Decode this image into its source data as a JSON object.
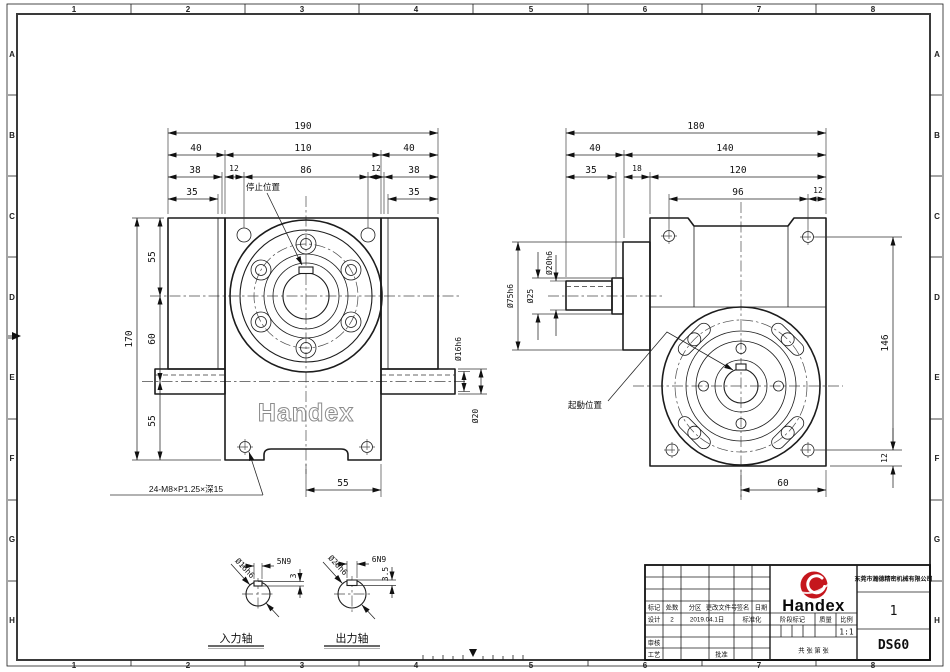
{
  "grid": {
    "cols": [
      "1",
      "2",
      "3",
      "4",
      "5",
      "6",
      "7",
      "8"
    ],
    "rows": [
      "A",
      "B",
      "C",
      "D",
      "E",
      "F",
      "G",
      "H"
    ]
  },
  "front_view": {
    "w190": "190",
    "w40l": "40",
    "w110": "110",
    "w40r": "40",
    "w38l": "38",
    "w12l": "12",
    "w86": "86",
    "w12r": "12",
    "w38r": "38",
    "w35l": "35",
    "w35r": "35",
    "stop_label": "停止位置",
    "h170": "170",
    "h55t": "55",
    "h60": "60",
    "h55b": "55",
    "d16": "Ø16h6",
    "d20": "Ø20",
    "b55": "55",
    "tap_note": "24-M8×P1.25×深15",
    "emboss": "Handex"
  },
  "side_view": {
    "w180": "180",
    "w40": "40",
    "w140": "140",
    "w35": "35",
    "w18": "18",
    "w120": "120",
    "w96": "96",
    "w12": "12",
    "d75": "Ø75h6",
    "d25": "Ø25",
    "d20": "Ø20h6",
    "h146": "146",
    "h12": "12",
    "b60": "60",
    "start_label": "起動位置"
  },
  "input_detail": {
    "dia": "Ø16h6",
    "key": "5N9",
    "depth": "3",
    "title": "入力轴"
  },
  "output_detail": {
    "dia": "Ø20h6",
    "key": "6N9",
    "depth": "3.5",
    "title": "出力轴"
  },
  "title_block": {
    "company": "东莞市瀚德精密机械有限公司",
    "brand": "Handex",
    "sheet_no": "1",
    "model": "DS60",
    "scale_value": "1:1",
    "h_mark": "标记",
    "h_count": "处数",
    "h_zone": "分区",
    "h_doc": "更改文件号",
    "h_sign": "签名",
    "h_date": "日期",
    "r_design": "设计",
    "design_sign": "2",
    "design_date": "2019.04.1日",
    "r_std": "标准化",
    "r_check": "审核",
    "r_process": "工艺",
    "r_approve": "批准",
    "h_stage": "阶段标记",
    "h_weight": "质量",
    "h_scale": "比例",
    "sheets": "共 张 第 张"
  }
}
